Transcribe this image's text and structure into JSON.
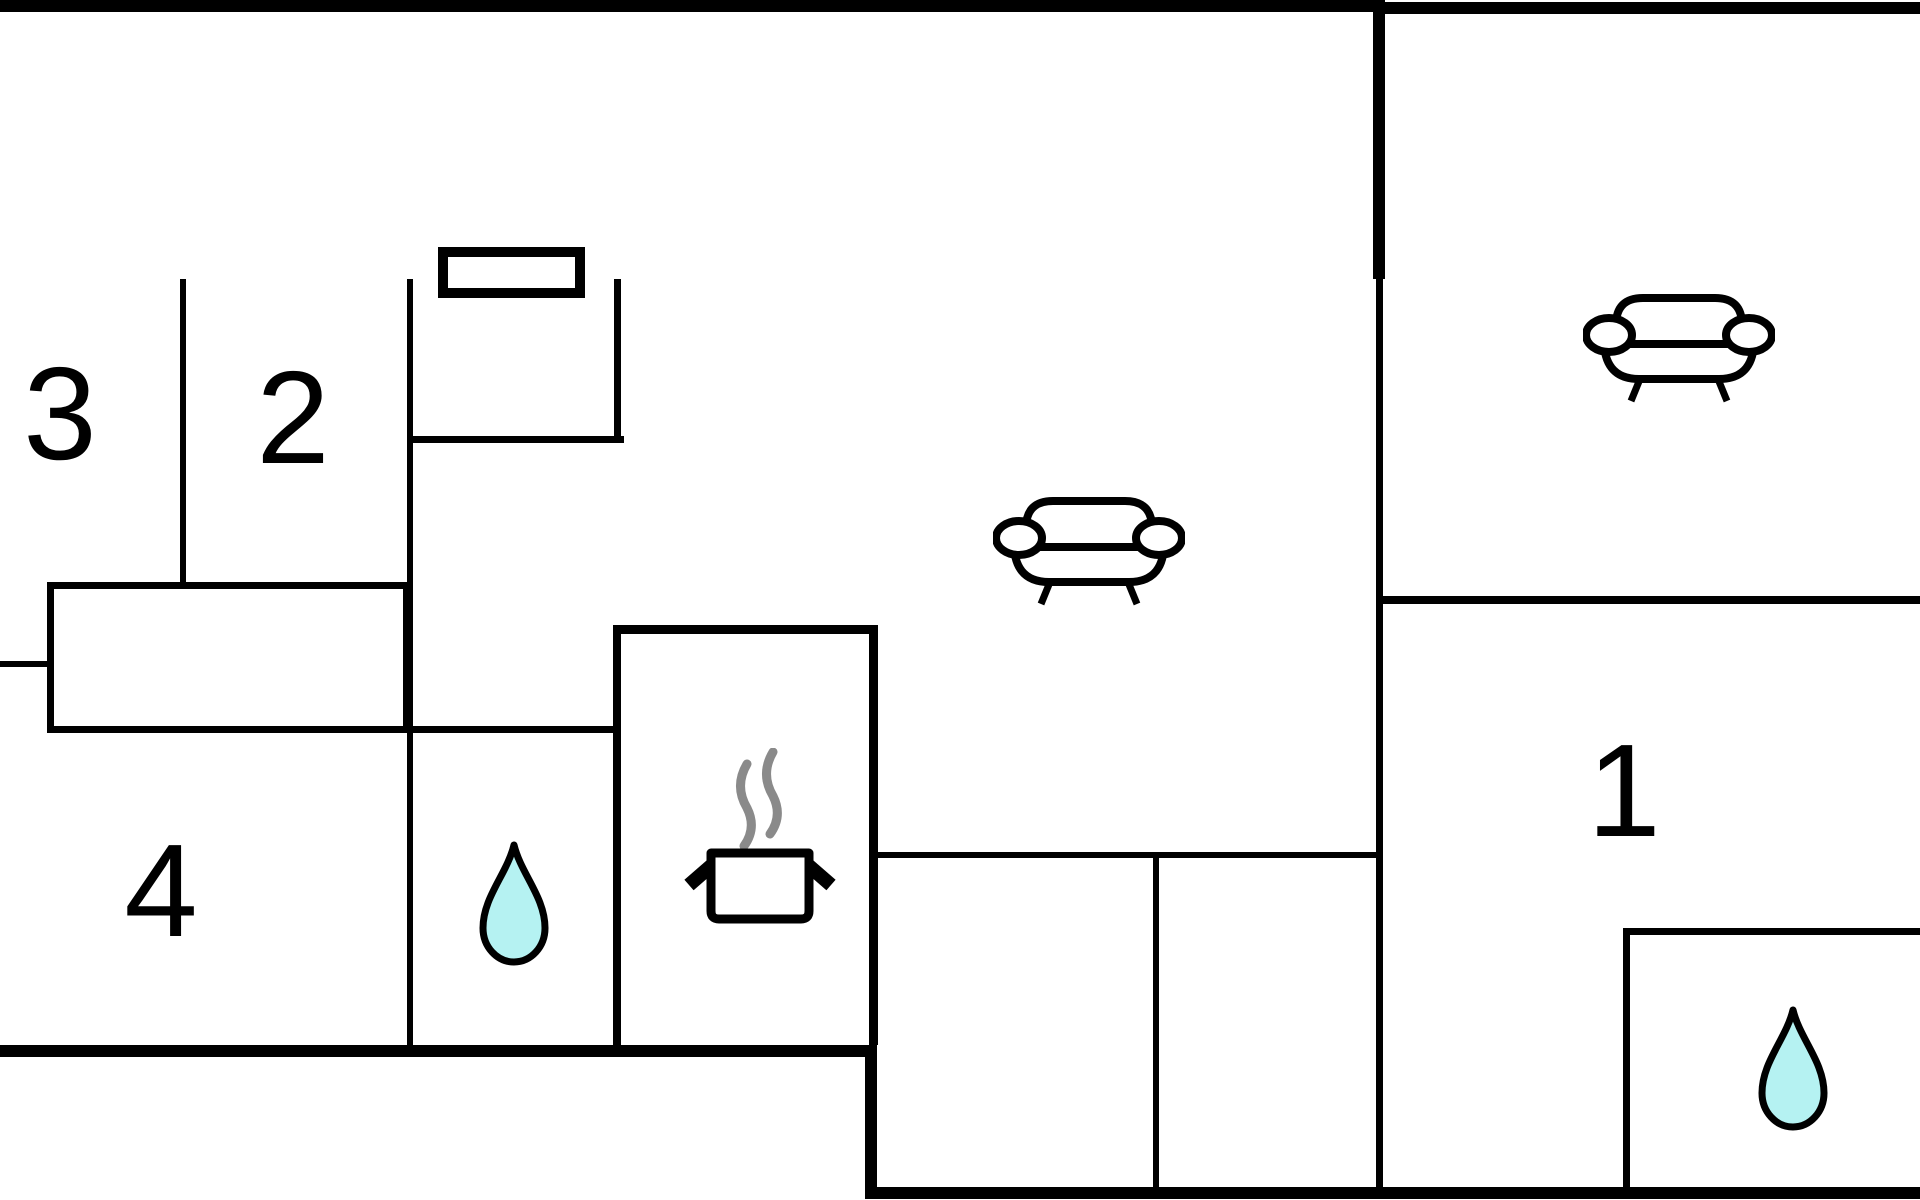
{
  "document": {
    "type": "floor-plan",
    "background_color": "#ffffff",
    "wall_color": "#000000"
  },
  "colors": {
    "wall": "#000000",
    "room_label": "#000000",
    "water_drop_fill": "#b5f2f2",
    "water_drop_outline": "#000000",
    "steam": "#8a8a8a",
    "furniture_outline": "#000000"
  },
  "rooms": {
    "room1": {
      "label": "1"
    },
    "room2": {
      "label": "2"
    },
    "room3": {
      "label": "3"
    },
    "room4": {
      "label": "4"
    }
  },
  "icons": [
    {
      "name": "sofa-icon",
      "location": "center-living-room"
    },
    {
      "name": "sofa-icon",
      "location": "top-right-room"
    },
    {
      "name": "cooking-pot-icon",
      "location": "kitchen"
    },
    {
      "name": "steam-icon",
      "location": "kitchen"
    },
    {
      "name": "water-drop-icon",
      "location": "left-bathroom"
    },
    {
      "name": "water-drop-icon",
      "location": "bottom-right-bathroom"
    },
    {
      "name": "window-icon",
      "location": "top-wall"
    }
  ]
}
